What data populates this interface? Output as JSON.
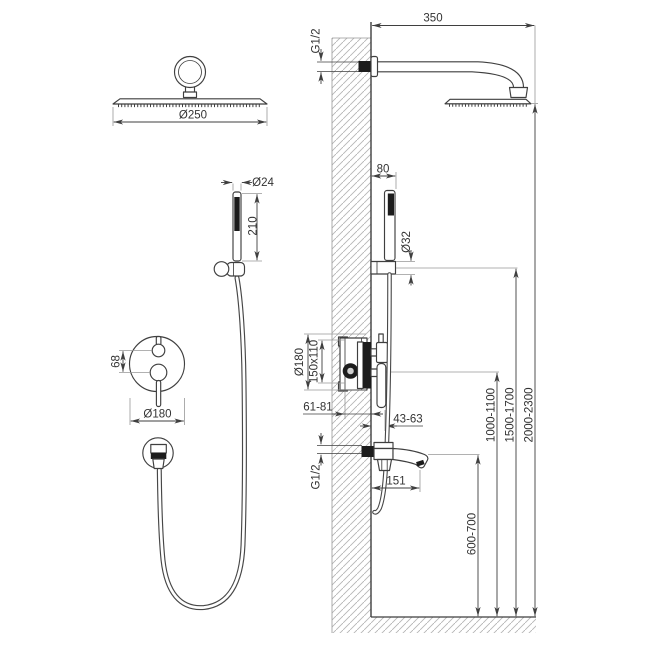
{
  "drawing": {
    "title": "concealed shower system installation diagram",
    "front": {
      "overhead_dia": "Ø250",
      "hand_dia": "Ø24",
      "hand_len": "210",
      "mixer_gap": "68",
      "mixer_dia": "Ø180"
    },
    "side": {
      "arm_len": "350",
      "g12_top": "G1/2",
      "hand_offset": "80",
      "holder_dia": "Ø32",
      "valve_dia": "Ø180",
      "valve_box": "150x110",
      "valve_depth": "61-81",
      "trim_depth": "43-63",
      "spout_g12": "G1/2",
      "spout_len": "151",
      "h_spout": "600-700",
      "h_valve": "1000-1100",
      "h_holder": "1500-1700",
      "h_head": "2000-2300"
    },
    "colors": {
      "line": "#3f3f3f",
      "light": "#979797",
      "dark_fill": "#1c1c1c",
      "background": "#ffffff"
    }
  }
}
